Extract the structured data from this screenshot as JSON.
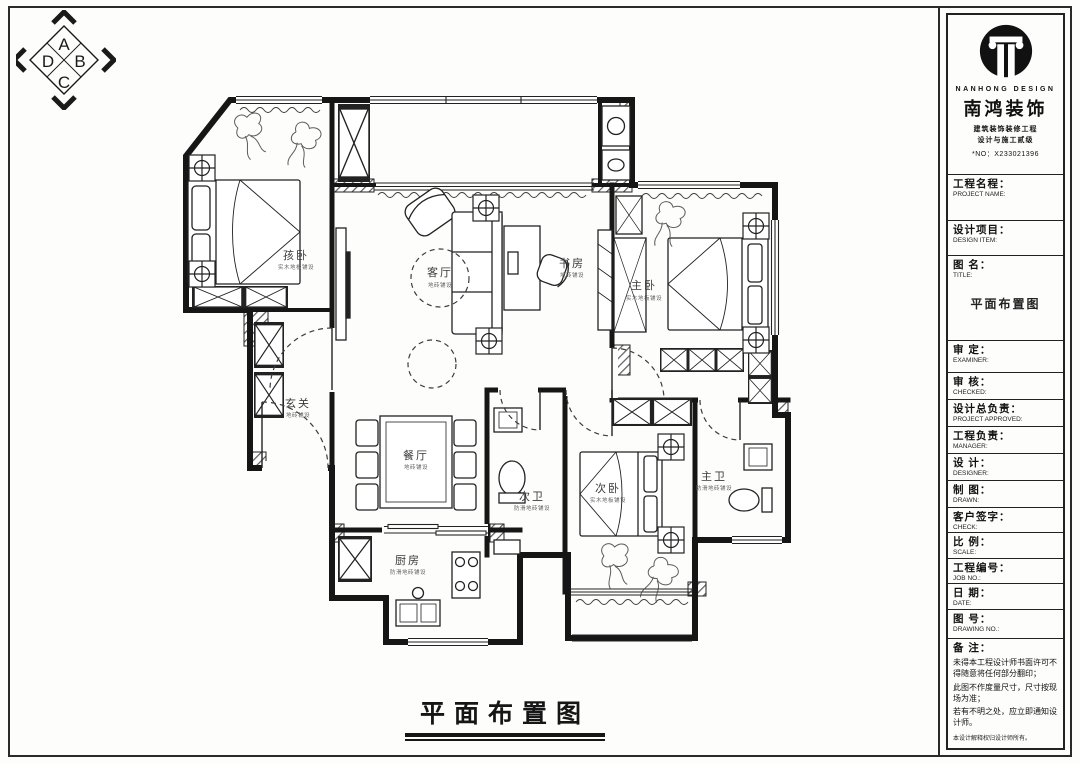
{
  "compass": {
    "a": "A",
    "b": "B",
    "c": "C",
    "d": "D"
  },
  "drawing_title": {
    "text": "平面布置图"
  },
  "brand": {
    "name_en": "NANHONG DESIGN",
    "name_cn": "南鸿装饰",
    "cert_line1": "建筑装饰装修工程",
    "cert_line2": "设计与施工贰级",
    "license_no": "*NO：X233021396"
  },
  "title_block": {
    "project_name": {
      "cn": "工程名程：",
      "en": "PROJECT NAME:"
    },
    "design_item": {
      "cn": "设计项目：",
      "en": "DESIGN ITEM:"
    },
    "drawing_name": {
      "cn": "图  名：",
      "en": "TITLE:",
      "value": "平面布置图"
    },
    "examiner": {
      "cn": "审  定：",
      "en": "EXAMINER:"
    },
    "checked": {
      "cn": "审  核：",
      "en": "CHECKED:"
    },
    "project_approved": {
      "cn": "设计总负责：",
      "en": "PROJECT APPROVED:"
    },
    "manager": {
      "cn": "工程负责：",
      "en": "MANAGER:"
    },
    "designer": {
      "cn": "设  计：",
      "en": "DESIGNER:"
    },
    "drawn": {
      "cn": "制  图：",
      "en": "DRAWN:"
    },
    "client_sign": {
      "cn": "客户签字：",
      "en": "CHECK:"
    },
    "scale": {
      "cn": "比  例：",
      "en": "SCALE:"
    },
    "job_no": {
      "cn": "工程编号：",
      "en": "JOB NO.:"
    },
    "date": {
      "cn": "日  期：",
      "en": "DATE:"
    },
    "drawing_no": {
      "cn": "图  号：",
      "en": "DRAWING NO.:"
    },
    "notes": {
      "label": "备 注：",
      "line1": "未得本工程设计师书面许可不得随意将任何部分翻印；",
      "line2": "此图不作度量尺寸，尺寸按现场为准；",
      "line3": "若有不明之处，应立即通知设计师。",
      "line4": "本设计解释权归设计师所有。",
      "hotline": "免费咨询电话:400 8383 168"
    }
  },
  "rooms": {
    "child_bedroom": {
      "name": "孩卧",
      "sub": "实木地板铺设"
    },
    "living": {
      "name": "客厅",
      "sub": "地砖铺设"
    },
    "study": {
      "name": "书房",
      "sub": "地砖铺设"
    },
    "master_bedroom": {
      "name": "主卧",
      "sub": "实木地板铺设"
    },
    "entry": {
      "name": "玄关",
      "sub": "地砖铺设"
    },
    "dining": {
      "name": "餐厅",
      "sub": "地砖铺设"
    },
    "second_bath": {
      "name": "次卫",
      "sub": "防滑地砖铺设"
    },
    "second_bedroom": {
      "name": "次卧",
      "sub": "实木地板铺设"
    },
    "master_bath": {
      "name": "主卫",
      "sub": "防滑地砖铺设"
    },
    "kitchen": {
      "name": "厨房",
      "sub": "防滑地砖铺设"
    }
  }
}
